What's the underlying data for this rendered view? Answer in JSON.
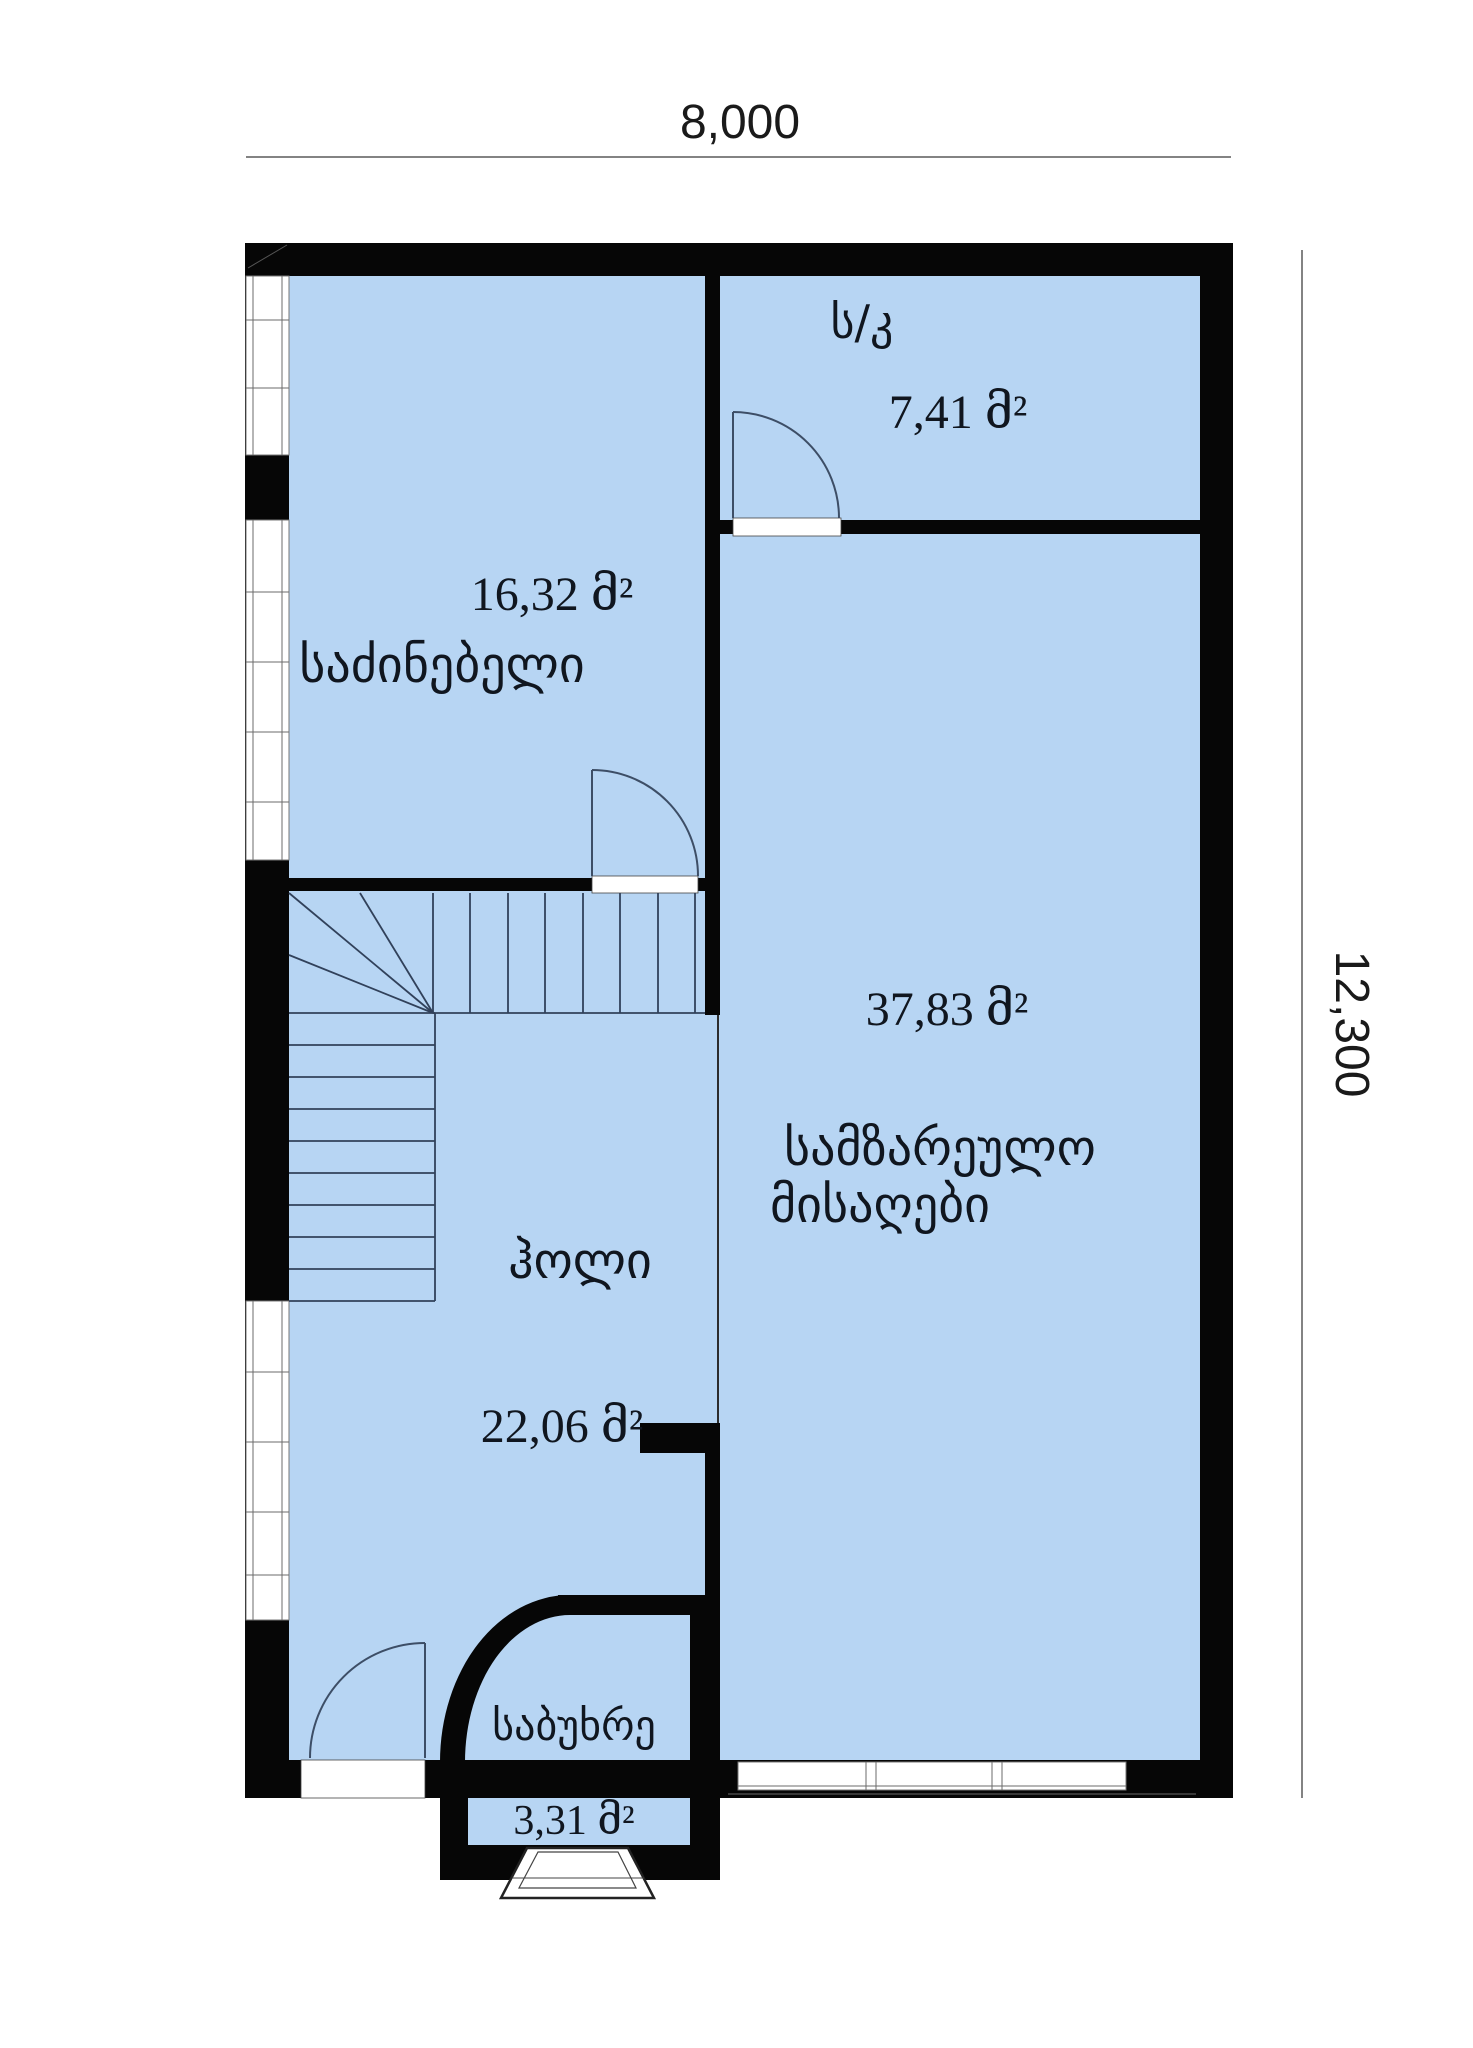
{
  "plan": {
    "type": "floor-plan",
    "dimensions": {
      "width_label": "8,000",
      "height_label": "12,300"
    },
    "rooms": {
      "bathroom": {
        "name": "ს/კ",
        "area": "7,41 მ²"
      },
      "bedroom": {
        "name": "საძინებელი",
        "area": "16,32 მ²"
      },
      "living": {
        "name_line1": "სამზარეულო",
        "name_line2": "მისაღები",
        "area": "37,83 მ²"
      },
      "hall": {
        "name": "ჰოლი",
        "area": "22,06 მ²"
      },
      "vestibule": {
        "name": "საბუხრე",
        "area": "3,31 მ²"
      }
    },
    "colors": {
      "floor": "#b7d5f3",
      "wall": "#060606",
      "stair_line": "#31415a",
      "door_line": "#3d4e66"
    }
  }
}
